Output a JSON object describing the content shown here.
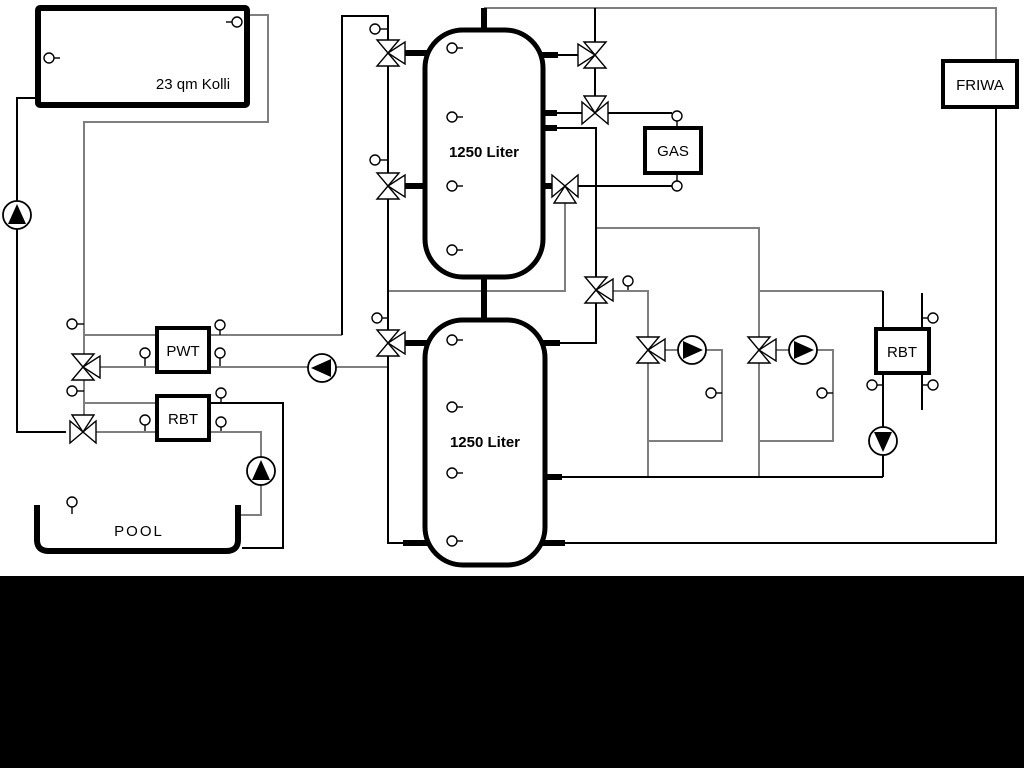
{
  "canvas": {
    "width": 1024,
    "height": 768,
    "background": "#ffffff"
  },
  "footer_band": {
    "x": 0,
    "y": 576,
    "width": 1024,
    "height": 192,
    "color": "#000000"
  },
  "colors": {
    "pipe_gray": "#7f7f7f",
    "pipe_black": "#000000",
    "fill_white": "#ffffff"
  },
  "labels": {
    "collector": "23 qm Kolli",
    "tank_top": "1250 Liter",
    "tank_bottom": "1250 Liter",
    "gas_boiler": "GAS",
    "friwa_station": "FRIWA",
    "heat_exchanger": "PWT",
    "rbt_left": "RBT",
    "rbt_right": "RBT",
    "pool": "POOL"
  },
  "boxes": [
    {
      "id": "collector",
      "x": 38,
      "y": 8,
      "w": 209,
      "h": 97,
      "sw": 6,
      "rx": 2,
      "label": "23 qm Kolli",
      "lx": 193,
      "ly": 89,
      "size": 15,
      "bold": false,
      "ls": 0
    },
    {
      "id": "tank-top",
      "x": 425,
      "y": 30,
      "w": 118,
      "h": 247,
      "sw": 5,
      "rx": 38,
      "label": "1250 Liter",
      "lx": 484,
      "ly": 157,
      "size": 15,
      "bold": true,
      "ls": 0
    },
    {
      "id": "tank-bottom",
      "x": 425,
      "y": 320,
      "w": 120,
      "h": 245,
      "sw": 5,
      "rx": 38,
      "label": "1250 Liter",
      "lx": 485,
      "ly": 447,
      "size": 15,
      "bold": true,
      "ls": 0
    },
    {
      "id": "gas-boiler",
      "x": 645,
      "y": 128,
      "w": 56,
      "h": 45,
      "sw": 4,
      "rx": 0,
      "label": "GAS",
      "lx": 673,
      "ly": 156,
      "size": 15,
      "bold": false,
      "ls": 0
    },
    {
      "id": "friwa-station",
      "x": 943,
      "y": 61,
      "w": 74,
      "h": 46,
      "sw": 4,
      "rx": 0,
      "label": "FRIWA",
      "lx": 980,
      "ly": 90,
      "size": 15,
      "bold": false,
      "ls": 0
    },
    {
      "id": "pwt-heat-exchanger",
      "x": 157,
      "y": 328,
      "w": 52,
      "h": 44,
      "sw": 4,
      "rx": 0,
      "label": "PWT",
      "lx": 183,
      "ly": 356,
      "size": 15,
      "bold": false,
      "ls": 0
    },
    {
      "id": "rbt-left",
      "x": 157,
      "y": 396,
      "w": 52,
      "h": 44,
      "sw": 4,
      "rx": 0,
      "label": "RBT",
      "lx": 183,
      "ly": 424,
      "size": 15,
      "bold": false,
      "ls": 0
    },
    {
      "id": "rbt-right",
      "x": 876,
      "y": 329,
      "w": 53,
      "h": 44,
      "sw": 4,
      "rx": 0,
      "label": "RBT",
      "lx": 902,
      "ly": 357,
      "size": 15,
      "bold": false,
      "ls": 0
    }
  ],
  "pool": {
    "path": "M 37 505 L 37 540 Q 37 551 49 551 L 226 551 Q 238 551 238 540 L 238 505",
    "sw": 6,
    "label": "POOL",
    "lx": 139,
    "ly": 536,
    "size": 15,
    "ls": 2
  },
  "pipes": [
    {
      "c": "g",
      "pts": [
        [
          247,
          15
        ],
        [
          268,
          15
        ],
        [
          268,
          122
        ],
        [
          84,
          122
        ],
        [
          84,
          430
        ]
      ]
    },
    {
      "c": "g",
      "pts": [
        [
          84,
          335
        ],
        [
          157,
          335
        ]
      ]
    },
    {
      "c": "g",
      "pts": [
        [
          83,
          367
        ],
        [
          157,
          367
        ]
      ]
    },
    {
      "c": "g",
      "pts": [
        [
          209,
          335
        ],
        [
          342,
          335
        ]
      ]
    },
    {
      "c": "g",
      "pts": [
        [
          209,
          367
        ],
        [
          388,
          367
        ]
      ]
    },
    {
      "c": "g",
      "pts": [
        [
          84,
          403
        ],
        [
          157,
          403
        ]
      ]
    },
    {
      "c": "g",
      "pts": [
        [
          83,
          432
        ],
        [
          157,
          432
        ]
      ]
    },
    {
      "c": "g",
      "pts": [
        [
          209,
          432
        ],
        [
          261,
          432
        ],
        [
          261,
          515
        ],
        [
          240,
          515
        ]
      ]
    },
    {
      "c": "g",
      "pts": [
        [
          565,
          199
        ],
        [
          565,
          291
        ],
        [
          388,
          291
        ]
      ]
    },
    {
      "c": "g",
      "pts": [
        [
          596,
          228
        ],
        [
          759,
          228
        ],
        [
          759,
          477
        ]
      ]
    },
    {
      "c": "g",
      "pts": [
        [
          596,
          291
        ],
        [
          648,
          291
        ],
        [
          648,
          477
        ]
      ]
    },
    {
      "c": "g",
      "pts": [
        [
          648,
          350
        ],
        [
          722,
          350
        ],
        [
          722,
          441
        ],
        [
          648,
          441
        ]
      ]
    },
    {
      "c": "g",
      "pts": [
        [
          759,
          350
        ],
        [
          833,
          350
        ],
        [
          833,
          441
        ],
        [
          759,
          441
        ]
      ]
    },
    {
      "c": "g",
      "pts": [
        [
          759,
          291
        ],
        [
          883,
          291
        ]
      ]
    },
    {
      "c": "g",
      "pts": [
        [
          484,
          8
        ],
        [
          996,
          8
        ],
        [
          996,
          61
        ]
      ]
    },
    {
      "c": "k",
      "pts": [
        [
          38,
          98
        ],
        [
          17,
          98
        ],
        [
          17,
          432
        ],
        [
          66,
          432
        ]
      ]
    },
    {
      "c": "k",
      "pts": [
        [
          342,
          335
        ],
        [
          342,
          16
        ],
        [
          388,
          16
        ],
        [
          388,
          543
        ],
        [
          414,
          543
        ]
      ]
    },
    {
      "c": "k",
      "pts": [
        [
          595,
          8
        ],
        [
          595,
          113
        ]
      ]
    },
    {
      "c": "k",
      "pts": [
        [
          556,
          55
        ],
        [
          580,
          55
        ]
      ]
    },
    {
      "c": "k",
      "pts": [
        [
          556,
          113
        ],
        [
          582,
          113
        ]
      ]
    },
    {
      "c": "k",
      "pts": [
        [
          556,
          128
        ],
        [
          596,
          128
        ],
        [
          596,
          343
        ],
        [
          548,
          343
        ]
      ]
    },
    {
      "c": "k",
      "pts": [
        [
          548,
          186
        ],
        [
          672,
          186
        ]
      ]
    },
    {
      "c": "k",
      "pts": [
        [
          608,
          113
        ],
        [
          672,
          113
        ]
      ]
    },
    {
      "c": "k",
      "pts": [
        [
          883,
          291
        ],
        [
          883,
          330
        ]
      ]
    },
    {
      "c": "k",
      "pts": [
        [
          883,
          373
        ],
        [
          883,
          477
        ]
      ]
    },
    {
      "c": "k",
      "pts": [
        [
          922,
          293
        ],
        [
          922,
          410
        ]
      ]
    },
    {
      "c": "k",
      "pts": [
        [
          548,
          477
        ],
        [
          883,
          477
        ]
      ]
    },
    {
      "c": "k",
      "pts": [
        [
          548,
          543
        ],
        [
          996,
          543
        ],
        [
          996,
          107
        ]
      ]
    },
    {
      "c": "k",
      "pts": [
        [
          209,
          403
        ],
        [
          283,
          403
        ],
        [
          283,
          548
        ],
        [
          242,
          548
        ]
      ]
    }
  ],
  "stubs": [
    [
      [
        484,
        8
      ],
      [
        484,
        33
      ]
    ],
    [
      [
        484,
        274
      ],
      [
        484,
        323
      ]
    ],
    [
      [
        402,
        53
      ],
      [
        428,
        53
      ]
    ],
    [
      [
        402,
        186
      ],
      [
        428,
        186
      ]
    ],
    [
      [
        542,
        55
      ],
      [
        558,
        55
      ]
    ],
    [
      [
        542,
        113
      ],
      [
        557,
        113
      ]
    ],
    [
      [
        542,
        128
      ],
      [
        557,
        128
      ]
    ],
    [
      [
        542,
        186
      ],
      [
        556,
        186
      ]
    ],
    [
      [
        402,
        343
      ],
      [
        428,
        343
      ]
    ],
    [
      [
        403,
        543
      ],
      [
        428,
        543
      ]
    ],
    [
      [
        542,
        343
      ],
      [
        560,
        343
      ]
    ],
    [
      [
        542,
        477
      ],
      [
        562,
        477
      ]
    ],
    [
      [
        542,
        543
      ],
      [
        565,
        543
      ]
    ]
  ],
  "valves": [
    {
      "x": 388,
      "y": 53,
      "type": "v+r",
      "name": "valve-tank1-top-left"
    },
    {
      "x": 388,
      "y": 186,
      "type": "v+r",
      "name": "valve-tank1-mid-left"
    },
    {
      "x": 388,
      "y": 343,
      "type": "v+r",
      "name": "valve-tank2-top-left"
    },
    {
      "x": 595,
      "y": 55,
      "type": "v+l",
      "name": "valve-tank1-top-right"
    },
    {
      "x": 595,
      "y": 113,
      "type": "h+t",
      "name": "valve-gas-supply"
    },
    {
      "x": 565,
      "y": 186,
      "type": "h+b",
      "name": "valve-gas-return"
    },
    {
      "x": 596,
      "y": 290,
      "type": "v+r",
      "name": "valve-distribution"
    },
    {
      "x": 648,
      "y": 350,
      "type": "v+r",
      "name": "valve-circuit-1"
    },
    {
      "x": 759,
      "y": 350,
      "type": "v+r",
      "name": "valve-circuit-2"
    },
    {
      "x": 83,
      "y": 367,
      "type": "v+r",
      "name": "valve-pwt"
    },
    {
      "x": 83,
      "y": 432,
      "type": "h+t",
      "name": "valve-pool"
    }
  ],
  "pumps": [
    {
      "x": 17,
      "y": 215,
      "dir": "up",
      "name": "pump-solar"
    },
    {
      "x": 322,
      "y": 368,
      "dir": "left",
      "name": "pump-pwt"
    },
    {
      "x": 261,
      "y": 471,
      "dir": "up",
      "name": "pump-pool"
    },
    {
      "x": 692,
      "y": 350,
      "dir": "right",
      "name": "pump-circuit-1"
    },
    {
      "x": 803,
      "y": 350,
      "dir": "right",
      "name": "pump-circuit-2"
    },
    {
      "x": 883,
      "y": 441,
      "dir": "down",
      "name": "pump-rbt-right"
    }
  ],
  "sensors": [
    {
      "c": [
        49,
        58
      ],
      "t": [
        60,
        58
      ]
    },
    {
      "c": [
        237,
        22
      ],
      "t": [
        226,
        22
      ]
    },
    {
      "c": [
        452,
        48
      ],
      "t": [
        463,
        48
      ]
    },
    {
      "c": [
        452,
        117
      ],
      "t": [
        463,
        117
      ]
    },
    {
      "c": [
        452,
        186
      ],
      "t": [
        463,
        186
      ]
    },
    {
      "c": [
        452,
        250
      ],
      "t": [
        463,
        250
      ]
    },
    {
      "c": [
        452,
        340
      ],
      "t": [
        463,
        340
      ]
    },
    {
      "c": [
        452,
        407
      ],
      "t": [
        463,
        407
      ]
    },
    {
      "c": [
        452,
        473
      ],
      "t": [
        463,
        473
      ]
    },
    {
      "c": [
        452,
        541
      ],
      "t": [
        463,
        541
      ]
    },
    {
      "c": [
        375,
        29
      ],
      "t": [
        388,
        29
      ]
    },
    {
      "c": [
        375,
        160
      ],
      "t": [
        388,
        160
      ]
    },
    {
      "c": [
        377,
        318
      ],
      "t": [
        388,
        318
      ]
    },
    {
      "c": [
        72,
        324
      ],
      "t": [
        84,
        324
      ]
    },
    {
      "c": [
        72,
        391
      ],
      "t": [
        84,
        391
      ]
    },
    {
      "c": [
        220,
        325
      ],
      "t": [
        220,
        335
      ]
    },
    {
      "c": [
        145,
        353
      ],
      "t": [
        145,
        366
      ]
    },
    {
      "c": [
        220,
        353
      ],
      "t": [
        220,
        366
      ]
    },
    {
      "c": [
        221,
        393
      ],
      "t": [
        221,
        403
      ]
    },
    {
      "c": [
        145,
        420
      ],
      "t": [
        145,
        431
      ]
    },
    {
      "c": [
        221,
        422
      ],
      "t": [
        221,
        431
      ]
    },
    {
      "c": [
        72,
        502
      ],
      "t": [
        72,
        514
      ]
    },
    {
      "c": [
        677,
        116
      ],
      "t": [
        677,
        127
      ]
    },
    {
      "c": [
        677,
        186
      ],
      "t": [
        677,
        174
      ]
    },
    {
      "c": [
        628,
        281
      ],
      "t": [
        628,
        290
      ]
    },
    {
      "c": [
        711,
        393
      ],
      "t": [
        722,
        393
      ]
    },
    {
      "c": [
        822,
        393
      ],
      "t": [
        833,
        393
      ]
    },
    {
      "c": [
        933,
        318
      ],
      "t": [
        922,
        318
      ]
    },
    {
      "c": [
        933,
        385
      ],
      "t": [
        922,
        385
      ]
    },
    {
      "c": [
        872,
        385
      ],
      "t": [
        883,
        385
      ]
    }
  ]
}
